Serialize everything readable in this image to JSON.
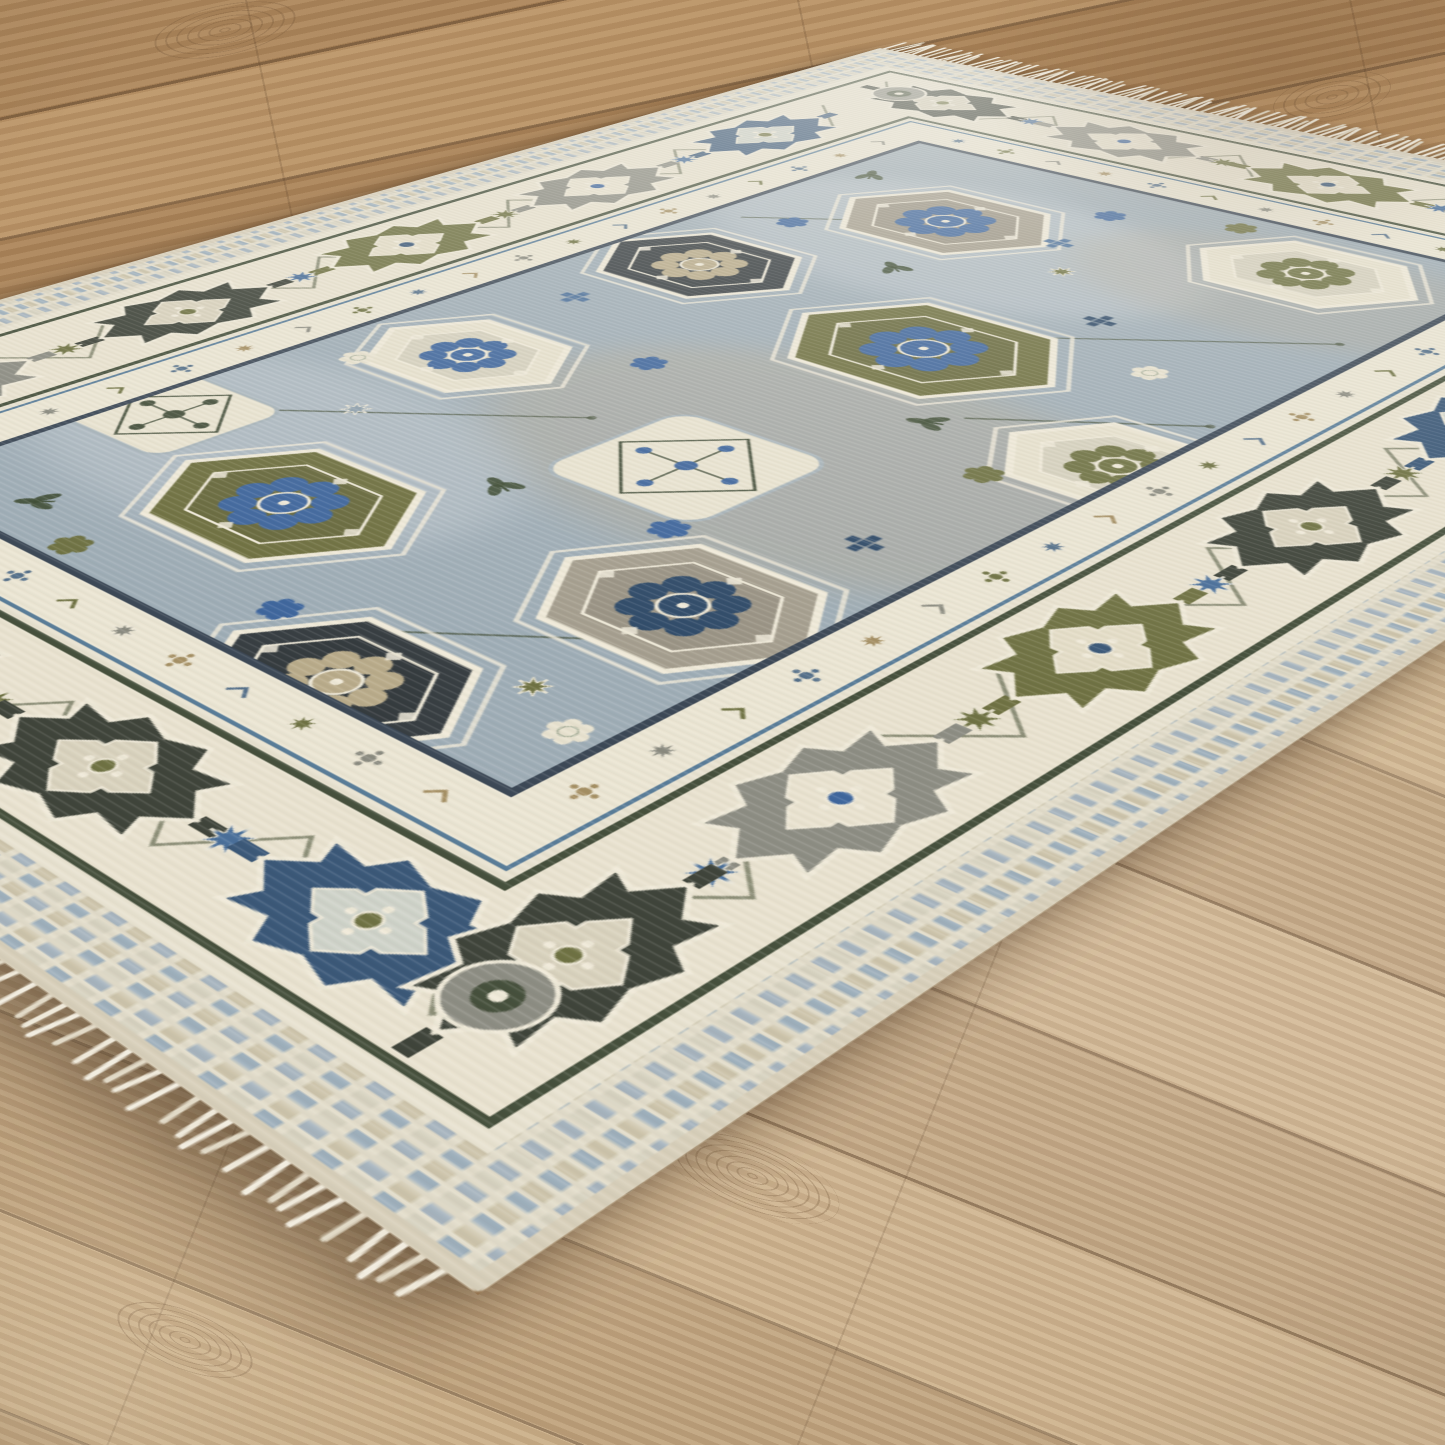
{
  "floor": {
    "back": {
      "base1": "#b38c60",
      "base2": "#a98055",
      "base3": "#bd9669",
      "seam": "rgba(86,62,40,0.45)"
    },
    "front": {
      "base1": "#c2a77f",
      "base2": "#ccb394",
      "base3": "#bda079",
      "seam": "rgba(92,68,46,0.40)"
    },
    "knots": [
      {
        "x": 150,
        "y": 4,
        "w": 150,
        "h": 52,
        "rot": -12
      },
      {
        "x": 1272,
        "y": 74,
        "w": 120,
        "h": 46,
        "rot": -12
      },
      {
        "x": 660,
        "y": 1140,
        "w": 185,
        "h": 72,
        "rot": 22
      },
      {
        "x": 110,
        "y": 1310,
        "w": 150,
        "h": 60,
        "rot": 22
      }
    ]
  },
  "rug": {
    "corners": {
      "A": [
        880,
        48
      ],
      "B": [
        1994,
        269
      ],
      "C": [
        -669,
        491
      ],
      "D": [
        478,
        1295
      ]
    },
    "flat_size": [
      1000,
      1430
    ],
    "palette": {
      "ivory": "#e9e2cf",
      "cream": "#efe9d8",
      "binding": "#d8cfba",
      "field_blue_grey": "#9fadb6",
      "olive": "#6f7040",
      "charcoal": "#3f443a",
      "slate": "#8d8d83",
      "navy": "#3b5878",
      "persian_blue": "#3f669d",
      "dark_green": "#3d4b33",
      "beige": "#b7aa92",
      "guard_line_olive": "#46503c",
      "guard_line_navy": "#3c4856",
      "steel": "#5a7d99"
    },
    "bands": [
      {
        "name": "binding",
        "inset": 0,
        "fill": "#d8cfba",
        "rx": 4
      },
      {
        "name": "outer-check-band",
        "inset": 8,
        "fill": "checks"
      },
      {
        "name": "cream-strip",
        "inset": 52,
        "fill": "#e8e2d0"
      },
      {
        "name": "dark-olive-line",
        "inset": 62,
        "fill": "#46503c"
      },
      {
        "name": "main-border",
        "inset": 67,
        "fill": "#e9e2cf"
      },
      {
        "name": "dark-olive-line2",
        "inset": 175,
        "fill": "#46503c"
      },
      {
        "name": "cream-line",
        "inset": 180,
        "fill": "#e8e2d0"
      },
      {
        "name": "steel-line",
        "inset": 186,
        "fill": "#5a7d99"
      },
      {
        "name": "guard-band",
        "inset": 189,
        "fill": "#ebe5d3"
      },
      {
        "name": "navy-line",
        "inset": 230,
        "fill": "#3c4856"
      },
      {
        "name": "field",
        "inset": 236,
        "fill": "#9fadb6"
      }
    ],
    "border": {
      "vine_color": "#5a6148",
      "corner_rosette_color": "#8d8d83",
      "accent_star_colors": [
        "#4a6f9a",
        "#6f7243"
      ],
      "schemes": {
        "charcoal": {
          "main": "#3f443a",
          "inner": "#d9d2bd",
          "accent": "#6f7243"
        },
        "slate": {
          "main": "#8d8d83",
          "inner": "#e9e2cf",
          "accent": "#3f669d"
        },
        "olive": {
          "main": "#707243",
          "inner": "#e4ddc7",
          "accent": "#3b5878"
        },
        "navy": {
          "main": "#3b5878",
          "inner": "#cfd3c9",
          "accent": "#6f7243"
        }
      },
      "sides": [
        {
          "orient": "h",
          "center": 121,
          "positions": [
            170,
            360,
            550,
            740
          ],
          "schemes": [
            "charcoal",
            "slate",
            "olive",
            "slate"
          ]
        },
        {
          "orient": "h",
          "center": 1309,
          "positions": [
            230,
            420,
            610,
            800
          ],
          "schemes": [
            "olive",
            "slate",
            "charcoal",
            "navy"
          ]
        },
        {
          "orient": "v",
          "center": 121,
          "positions": [
            300,
            500,
            700,
            900,
            1100,
            1270
          ],
          "schemes": [
            "navy",
            "slate",
            "olive",
            "charcoal",
            "slate",
            "olive"
          ]
        },
        {
          "orient": "v",
          "center": 879,
          "positions": [
            300,
            500,
            700,
            900,
            1100,
            1270
          ],
          "schemes": [
            "slate",
            "navy",
            "charcoal",
            "olive",
            "slate",
            "charcoal"
          ]
        }
      ],
      "corners": [
        [
          121,
          121
        ],
        [
          879,
          121
        ],
        [
          121,
          1309
        ],
        [
          879,
          1309
        ]
      ]
    },
    "guard": {
      "colors": [
        "#55708a",
        "#6f7243",
        "#8a8a7f",
        "#a58f63"
      ],
      "centers": {
        "top": 209.5,
        "bottom": 1220.5,
        "left": 209.5,
        "right": 790.5
      },
      "count_h": 11,
      "count_v": 19,
      "span_h": [
        256,
        744
      ],
      "span_v": [
        256,
        1174
      ]
    },
    "field": {
      "background": "#9fadb6",
      "mottle": [
        {
          "x": 420,
          "y": 430,
          "rx": 210,
          "ry": 125,
          "fill": "#c3cbd1",
          "op": 0.5
        },
        {
          "x": 610,
          "y": 810,
          "rx": 230,
          "ry": 150,
          "fill": "#b7aa92",
          "op": 0.38
        },
        {
          "x": 350,
          "y": 1010,
          "rx": 190,
          "ry": 115,
          "fill": "#c3cbd1",
          "op": 0.45
        },
        {
          "x": 660,
          "y": 360,
          "rx": 170,
          "ry": 100,
          "fill": "#b7aa92",
          "op": 0.3
        }
      ],
      "stems": [
        [
          262,
          486,
          430,
          360
        ],
        [
          596,
          548,
          742,
          434
        ],
        [
          300,
          986,
          470,
          852
        ],
        [
          556,
          1164,
          700,
          1052
        ],
        [
          640,
          700,
          758,
          612
        ],
        [
          280,
          640,
          360,
          570
        ]
      ],
      "medallions": [
        {
          "t": "hex",
          "x": 385,
          "y": 392,
          "w": 182,
          "h": 128,
          "fill": "#a59e8e",
          "accent": "#3f669d"
        },
        {
          "t": "hex",
          "x": 650,
          "y": 322,
          "w": 168,
          "h": 116,
          "fill": "#e7e1cd",
          "accent": "#6f7243"
        },
        {
          "t": "hex",
          "x": 545,
          "y": 620,
          "w": 204,
          "h": 142,
          "fill": "#6f7040",
          "accent": "#3f669d"
        },
        {
          "t": "hex",
          "x": 316,
          "y": 590,
          "w": 166,
          "h": 118,
          "fill": "#383e42",
          "accent": "#b9ab8a"
        },
        {
          "t": "sq",
          "x": 565,
          "y": 868,
          "s": 124,
          "fill": "#e9e3d0",
          "accent": "#3f669d"
        },
        {
          "t": "hex",
          "x": 330,
          "y": 828,
          "w": 152,
          "h": 108,
          "fill": "#e7e1cd",
          "accent": "#3f669d"
        },
        {
          "t": "hex",
          "x": 692,
          "y": 1005,
          "w": 170,
          "h": 120,
          "fill": "#a59e8e",
          "accent": "#2f4a68"
        },
        {
          "t": "hex",
          "x": 432,
          "y": 1062,
          "w": 182,
          "h": 126,
          "fill": "#6f7040",
          "accent": "#3f669d"
        },
        {
          "t": "sq",
          "x": 272,
          "y": 1022,
          "s": 100,
          "fill": "#e9e3d0",
          "accent": "#46503c"
        },
        {
          "t": "hex",
          "x": 625,
          "y": 1182,
          "w": 160,
          "h": 112,
          "fill": "#383e42",
          "accent": "#b9ab8a"
        },
        {
          "t": "hex",
          "x": 752,
          "y": 700,
          "w": 150,
          "h": 106,
          "fill": "#e7e1cd",
          "accent": "#6f7243"
        }
      ],
      "scatter": [
        {
          "t": "ros",
          "x": 470,
          "y": 300,
          "c": "#3f669d"
        },
        {
          "t": "ros",
          "x": 300,
          "y": 470,
          "c": "#3f669d"
        },
        {
          "t": "cross",
          "x": 600,
          "y": 500,
          "c": "#2f4a68"
        },
        {
          "t": "leaf",
          "x": 420,
          "y": 500,
          "c": "#3d4b33",
          "rot": 30
        },
        {
          "t": "ros",
          "x": 680,
          "y": 560,
          "c": "#e8e2cf"
        },
        {
          "t": "star",
          "x": 520,
          "y": 432,
          "c": "#6f7243"
        },
        {
          "t": "leaf",
          "x": 622,
          "y": 722,
          "c": "#3d4b33",
          "rot": -20
        },
        {
          "t": "ros",
          "x": 430,
          "y": 760,
          "c": "#3f669d"
        },
        {
          "t": "cross",
          "x": 300,
          "y": 700,
          "c": "#4a6f9a"
        },
        {
          "t": "ros",
          "x": 702,
          "y": 762,
          "c": "#6f7243"
        },
        {
          "t": "star",
          "x": 350,
          "y": 940,
          "c": "#8fa0ad"
        },
        {
          "t": "leaf",
          "x": 500,
          "y": 960,
          "c": "#3d4b33",
          "rot": 15
        },
        {
          "t": "ros",
          "x": 620,
          "y": 940,
          "c": "#3f669d"
        },
        {
          "t": "cross",
          "x": 712,
          "y": 882,
          "c": "#2f4a68"
        },
        {
          "t": "ros",
          "x": 280,
          "y": 880,
          "c": "#e8e2cf"
        },
        {
          "t": "ros",
          "x": 540,
          "y": 1150,
          "c": "#3f669d"
        },
        {
          "t": "leaf",
          "x": 320,
          "y": 1160,
          "c": "#3d4b33",
          "rot": -40
        },
        {
          "t": "star",
          "x": 700,
          "y": 1120,
          "c": "#6f7243"
        },
        {
          "t": "ros",
          "x": 390,
          "y": 1178,
          "c": "#6f7243"
        },
        {
          "t": "cross",
          "x": 480,
          "y": 380,
          "c": "#4a6f9a"
        },
        {
          "t": "ros",
          "x": 560,
          "y": 262,
          "c": "#6f7243"
        },
        {
          "t": "leaf",
          "x": 262,
          "y": 330,
          "c": "#3d4b33",
          "rot": 60
        },
        {
          "t": "star",
          "x": 262,
          "y": 1190,
          "c": "#8fa0ad"
        },
        {
          "t": "ros",
          "x": 745,
          "y": 1140,
          "c": "#e8e2cf"
        }
      ]
    },
    "fringe": {
      "colors": [
        "#f2ede0",
        "#e2dac7",
        "#efe9da"
      ],
      "top": {
        "count": 138,
        "len": 32
      },
      "bottom": {
        "count": 92,
        "len": 14
      }
    }
  }
}
